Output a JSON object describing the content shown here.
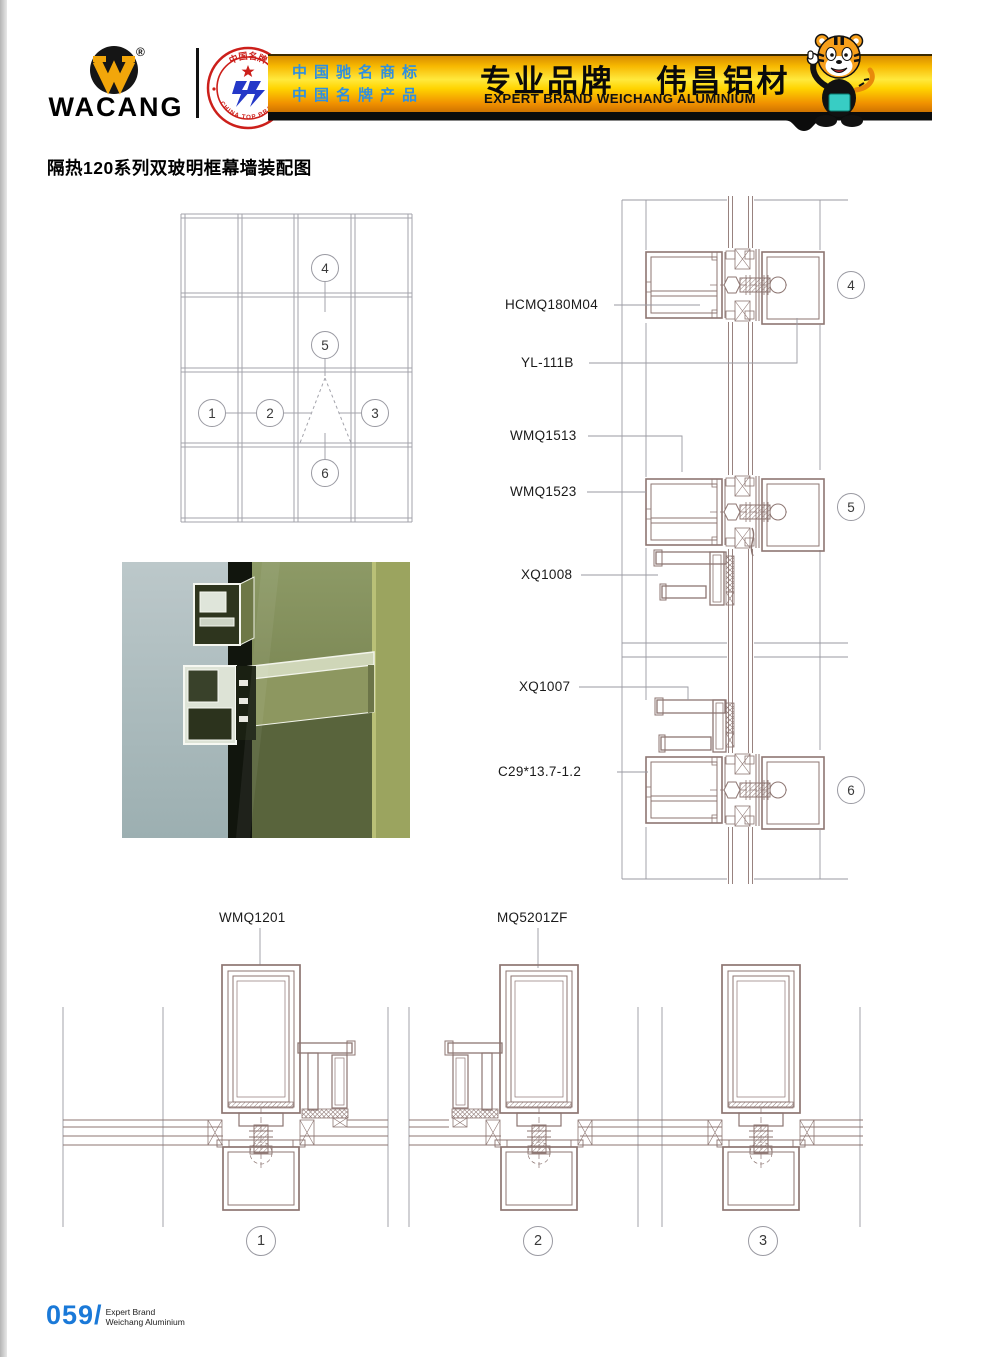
{
  "header": {
    "brand": "WACANG",
    "registered_mark": "®",
    "badge": {
      "arc_top": "中国名牌",
      "arc_bottom": "CHINA TOP BRAND"
    },
    "banner": {
      "line1_cn": "中国驰名商标",
      "line2_cn": "中国名牌产品",
      "slogan_cn_left": "专业品牌",
      "slogan_cn_right": "伟昌铝材",
      "slogan_en": "EXPERT BRAND WEICHANG ALUMINIUM"
    }
  },
  "document": {
    "title": "隔热120系列双玻明框幕墙装配图"
  },
  "elevation": {
    "callouts": [
      "1",
      "2",
      "3",
      "4",
      "5",
      "6"
    ]
  },
  "details": {
    "callouts": [
      "4",
      "5",
      "6"
    ],
    "labels": [
      "HCMQ180M04",
      "YL-111B",
      "WMQ1513",
      "WMQ1523",
      "XQ1008",
      "XQ1007",
      "C29*13.7-1.2"
    ]
  },
  "sections": {
    "callouts": [
      "1",
      "2",
      "3"
    ],
    "labels": [
      "WMQ1201",
      "MQ5201ZF"
    ]
  },
  "footer": {
    "page_number": "059/",
    "caption_line1": "Expert Brand",
    "caption_line2": "Weichang Aluminium"
  },
  "colors": {
    "banner_yellow": "#ffd900",
    "banner_orange": "#f09000",
    "banner_blue_text": "#2f8fe0",
    "badge_red": "#cc1f1a",
    "emblem_blue": "#2438c8",
    "logo_yellow": "#f2a60a",
    "footer_blue": "#1a79d8",
    "drawing_stroke": "#8d7672",
    "grid_stroke": "#a2a2aa"
  }
}
